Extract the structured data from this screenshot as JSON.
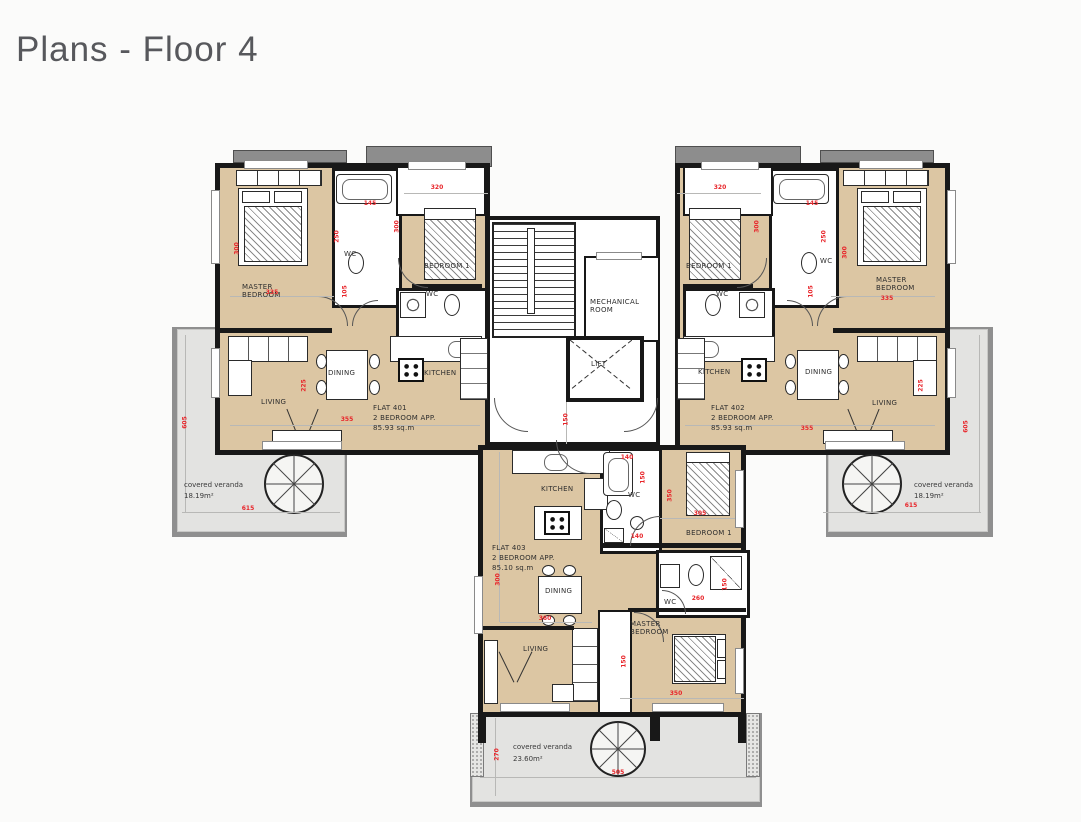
{
  "title": "Plans - Floor 4",
  "core": {
    "mechanical_room": "MECHANICAL ROOM",
    "lift": "LIFT"
  },
  "flat401": {
    "name": "FLAT 401",
    "type": "2 BEDROOM APP.",
    "area": "85.93 sq.m",
    "master_bedroom": "MASTER BEDROOM",
    "bedroom1": "BEDROOM 1",
    "living": "LIVING",
    "dining": "DINING",
    "kitchen": "KITCHEN",
    "wc_a": "WC",
    "wc_b": "WC"
  },
  "flat402": {
    "name": "FLAT 402",
    "type": "2 BEDROOM APP.",
    "area": "85.93 sq.m",
    "master_bedroom": "MASTER BEDROOM",
    "bedroom1": "BEDROOM 1",
    "living": "LIVING",
    "dining": "DINING",
    "kitchen": "KITCHEN",
    "wc_a": "WC",
    "wc_b": "WC"
  },
  "flat403": {
    "name": "FLAT 403",
    "type": "2 BEDROOM APP.",
    "area": "85.10 sq.m",
    "master_bedroom": "MASTER BEDROOM",
    "bedroom1": "BEDROOM 1",
    "living": "LIVING",
    "dining": "DINING",
    "kitchen": "KITCHEN",
    "wc_a": "WC",
    "wc_b": "WC"
  },
  "verandas": {
    "left_label": "covered veranda",
    "left_area": "18.19m²",
    "right_label": "covered veranda",
    "right_area": "18.19m²",
    "bottom_label": "covered veranda",
    "bottom_area": "23.60m²"
  },
  "colors": {
    "floor": "#dcc6a3",
    "veranda": "#e3e3e1",
    "wall": "#181818",
    "dimension_text": "#e8252a",
    "title_text": "#57585c"
  },
  "dims": {
    "d01": "320",
    "d02": "300",
    "d03": "335",
    "d04": "145",
    "d05": "250",
    "d06": "300",
    "d07": "105",
    "d08": "355",
    "d09": "225",
    "d10": "605",
    "d11": "615",
    "d12": "320",
    "d13": "300",
    "d14": "145",
    "d15": "250",
    "d16": "300",
    "d17": "105",
    "d18": "335",
    "d19": "355",
    "d20": "225",
    "d21": "605",
    "d22": "615",
    "d23": "150",
    "d24": "140",
    "d25": "150",
    "d26": "350",
    "d27": "305",
    "d28": "140",
    "d29": "300",
    "d30": "360",
    "d31": "260",
    "d32": "150",
    "d33": "150",
    "d34": "350",
    "d35": "270",
    "d36": "505"
  }
}
